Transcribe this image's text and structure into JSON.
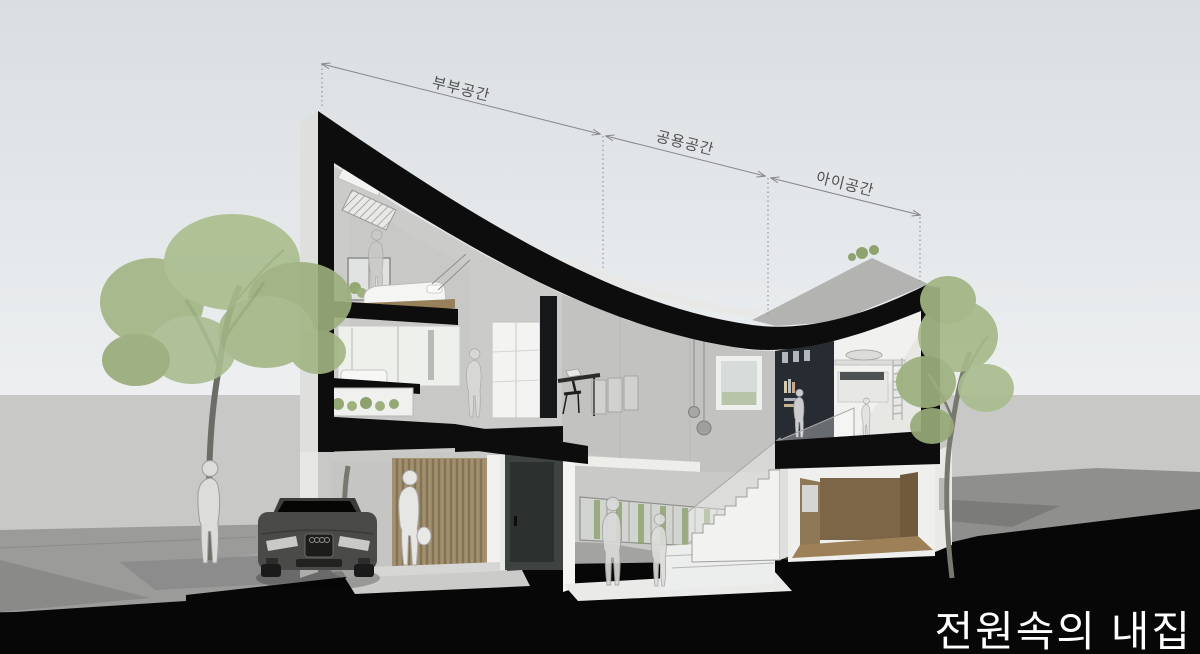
{
  "scene": {
    "description": "Architectural cross-section perspective rendering of a house with a curved sweeping roof, trees, parked car and human silhouettes",
    "type": "section-perspective-rendering"
  },
  "annotations": {
    "dimension_spans": [
      {
        "id": "couple-space",
        "label": "부부공간"
      },
      {
        "id": "shared-space",
        "label": "공용공간"
      },
      {
        "id": "kids-space",
        "label": "아이공간"
      }
    ]
  },
  "title": {
    "text": "전원속의 내집"
  },
  "colors": {
    "sky_top": "#d9dee2",
    "sky_bottom": "#eef0f1",
    "backdrop_wall": "#c8c9c6",
    "ground_left": "#9b9c9a",
    "ground_right": "#8f908d",
    "foreground_section_black": "#070707",
    "roof_section_black": "#0d0d0d",
    "concrete_wall": "#c7c8c5",
    "interior_white": "#f2f2f0",
    "bookshelf_dark": "#272c32",
    "wood_room": "#7d6647",
    "wood_slats": "#a29070",
    "tree_foliage": "#a5b888",
    "car_body": "#4a4b49",
    "figure_fill": "#e6e7e4",
    "dimension_line": "#85868a",
    "title_text": "#ffffff"
  }
}
